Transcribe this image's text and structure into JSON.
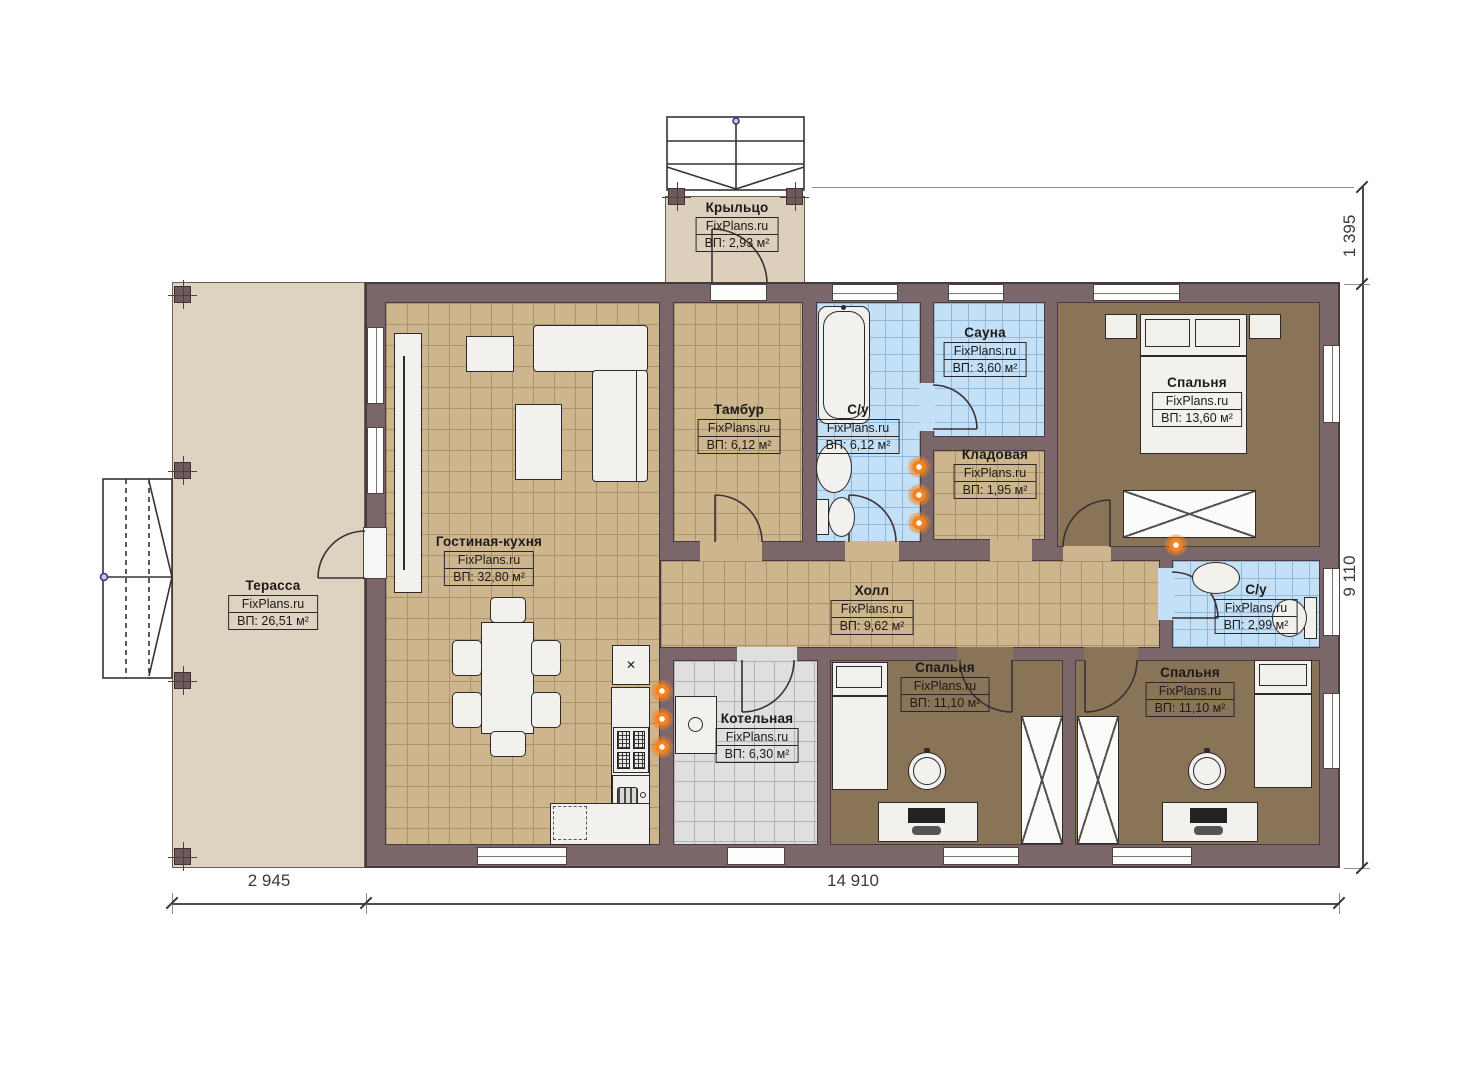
{
  "watermark": "FixPlans.ru",
  "rooms": {
    "porch": {
      "name": "Крыльцо",
      "area": "ВП: 2,93 м²"
    },
    "terrace": {
      "name": "Терасса",
      "area": "ВП: 26,51 м²"
    },
    "living": {
      "name": "Гостиная-кухня",
      "area": "ВП: 32,80 м²"
    },
    "vestibule": {
      "name": "Тамбур",
      "area": "ВП: 6,12 м²"
    },
    "bath1": {
      "name": "С/у",
      "area": "ВП: 6,12 м²"
    },
    "sauna": {
      "name": "Сауна",
      "area": "ВП: 3,60 м²"
    },
    "storage": {
      "name": "Кладовая",
      "area": "ВП: 1,95 м²"
    },
    "bedroom_master": {
      "name": "Спальня",
      "area": "ВП: 13,60 м²"
    },
    "hall": {
      "name": "Холл",
      "area": "ВП: 9,62 м²"
    },
    "boiler": {
      "name": "Котельная",
      "area": "ВП: 6,30 м²"
    },
    "bedroom_left": {
      "name": "Спальня",
      "area": "ВП: 11,10 м²"
    },
    "bedroom_right": {
      "name": "Спальня",
      "area": "ВП: 11,10 м²"
    },
    "bath2": {
      "name": "С/у",
      "area": "ВП: 2,99 м²"
    }
  },
  "dimensions": {
    "porch_depth": "1 395",
    "house_depth": "9 110",
    "terrace_width": "2 945",
    "house_width": "14 910"
  },
  "colors": {
    "wall": "#7b6669",
    "floor_tile_tan": "#cdb68d",
    "floor_wood_brown": "#8a7457",
    "floor_tile_blue": "#c3e0f6",
    "floor_tile_gray": "#dfdfdf",
    "terrace_deck": "#ded3c1",
    "radiator": "#f5821e"
  }
}
